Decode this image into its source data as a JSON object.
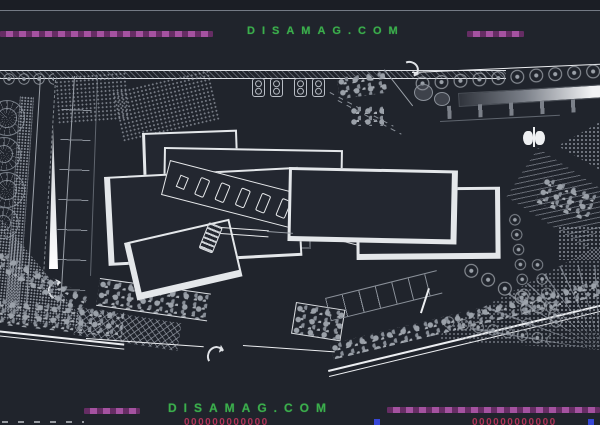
{
  "watermark": {
    "top": "DISAMAG.COM",
    "bottom": "DISAMAG.COM"
  },
  "footer_cropped": {
    "center_digits": "000000000000",
    "right_digits": "000000000000"
  },
  "colors": {
    "background": "#20242c",
    "canvas": "#232731",
    "building_fill": "#232730",
    "line_bright": "#eceef1",
    "line_grey": "#9aa0a8",
    "line_dim": "#5f656e",
    "accent_green": "#3bae4c",
    "accent_purple": "#a452a0",
    "accent_magenta": "#b03358",
    "accent_blue": "#3747d6"
  },
  "symbols": {
    "north_arrow": "north-arrow-icon",
    "tree_wheel": "tree-wheel-icon",
    "curved_arrow": "curved-arrow-icon"
  }
}
